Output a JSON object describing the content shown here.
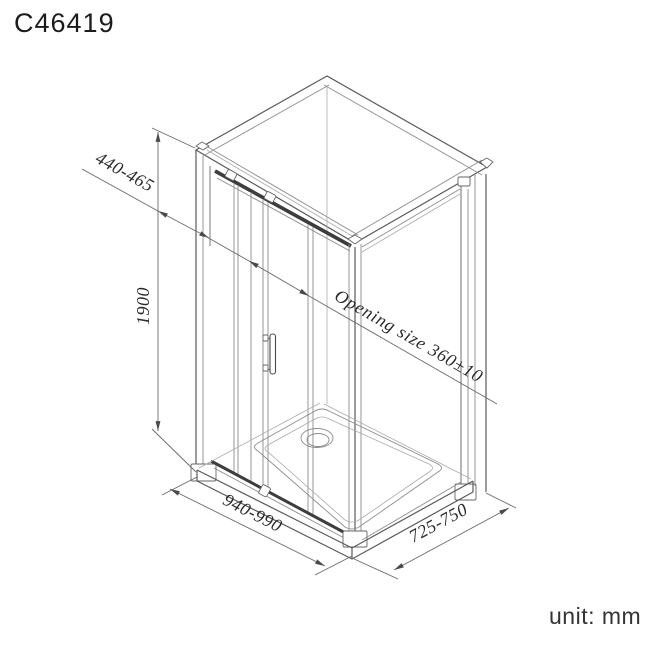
{
  "title": "C46419",
  "unit_label": "unit: mm",
  "drawing_subject": "isometric shower enclosure with sliding door and tray",
  "dimensions": {
    "panel_width": "440-465",
    "height": "1900",
    "opening_size": "Opening size 360±10",
    "front_width": "940-990",
    "side_depth": "725-750"
  },
  "colors": {
    "background": "#ffffff",
    "line_main": "#5a5a5a",
    "line_thin": "#8c8c8c",
    "line_faint": "#ababab",
    "rail_dark": "#3d3d3d",
    "dimension_line": "#6a6a6a",
    "arrow": "#4a4a4a",
    "text": "#2b2b2b",
    "title_text": "#1c1c1c"
  }
}
